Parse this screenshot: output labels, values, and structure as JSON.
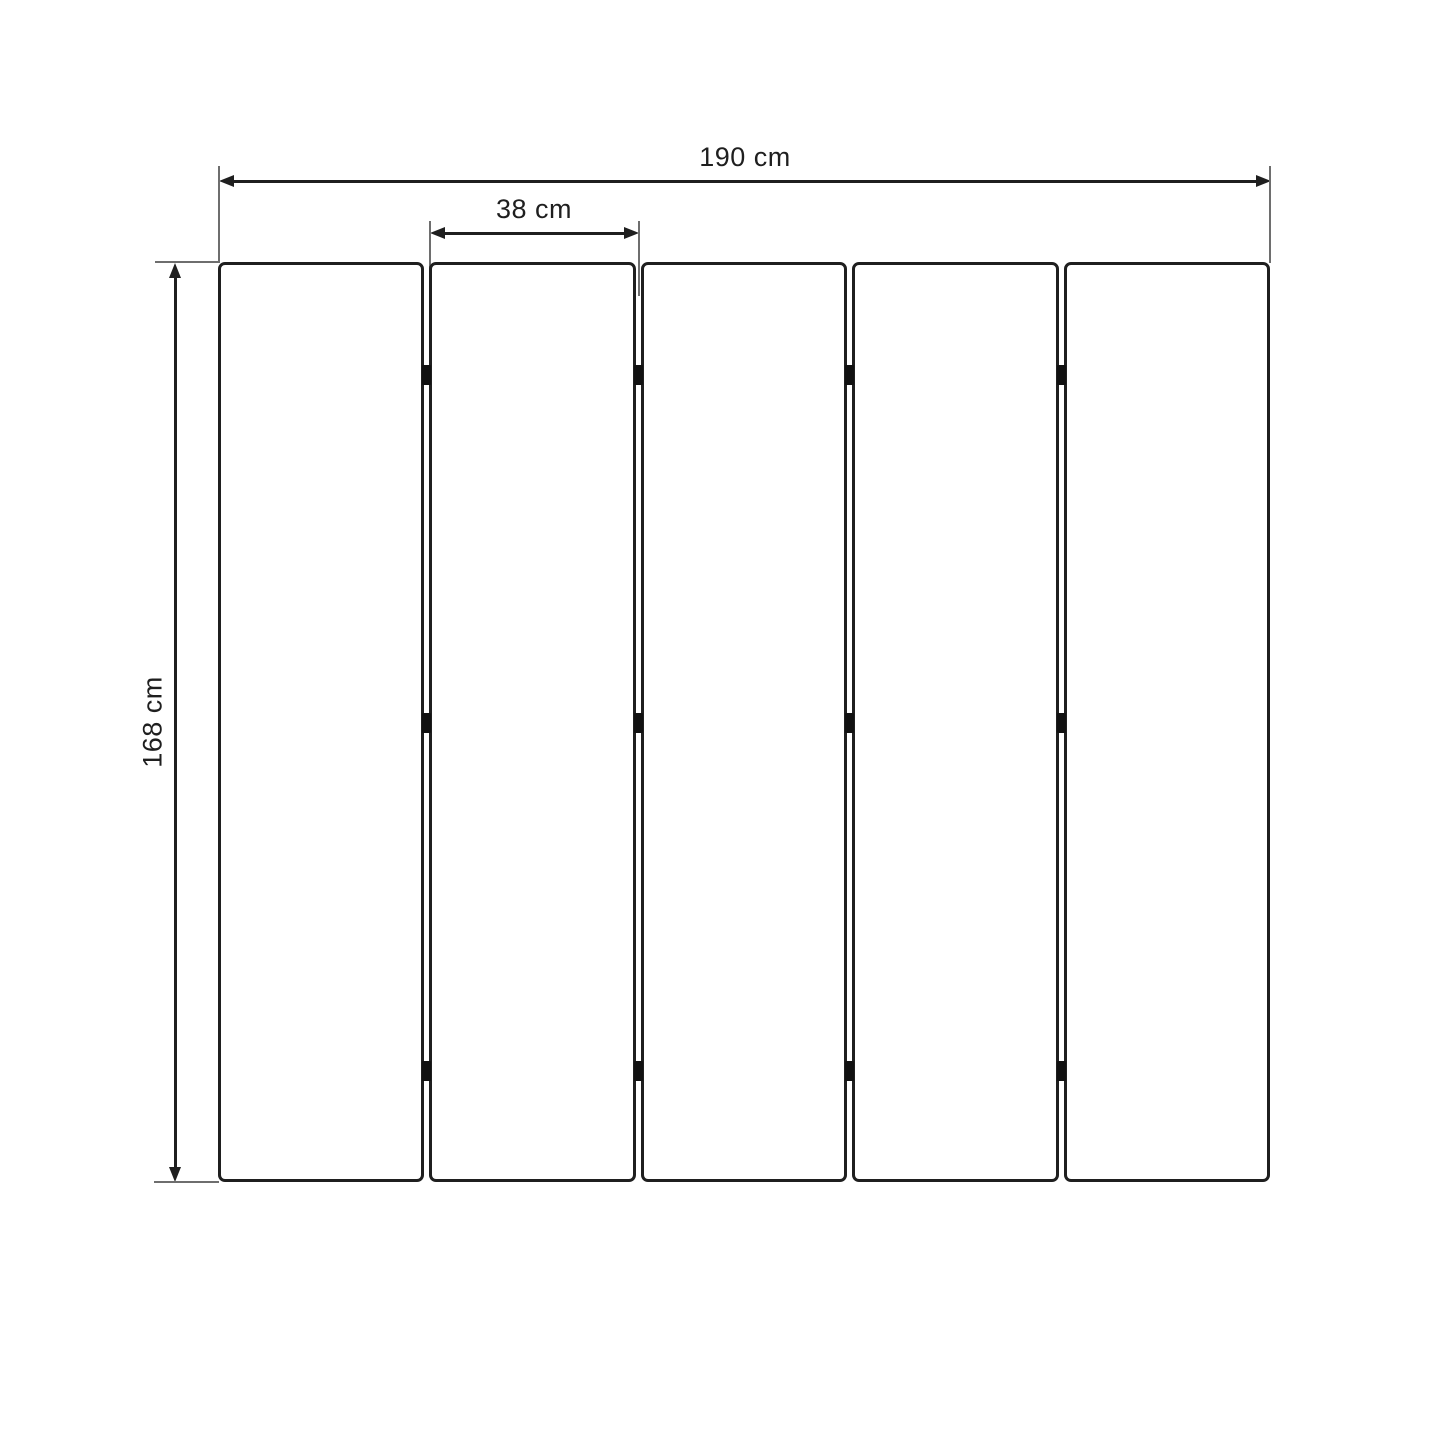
{
  "diagram": {
    "type": "dimension-drawing",
    "subject": "five-panel folding screen, front elevation",
    "dimensions": {
      "total_width": {
        "label": "190 cm",
        "value_cm": 190
      },
      "panel_width": {
        "label": "38 cm",
        "value_cm": 38
      },
      "height": {
        "label": "168 cm",
        "value_cm": 168
      }
    },
    "panels": {
      "count": 5,
      "seam_count": 4,
      "hinge_rows": 3
    },
    "colors": {
      "background": "#ffffff",
      "stroke": "#1f1f1f",
      "extension_line": "#6e6e6e",
      "hinge": "#111111"
    }
  }
}
